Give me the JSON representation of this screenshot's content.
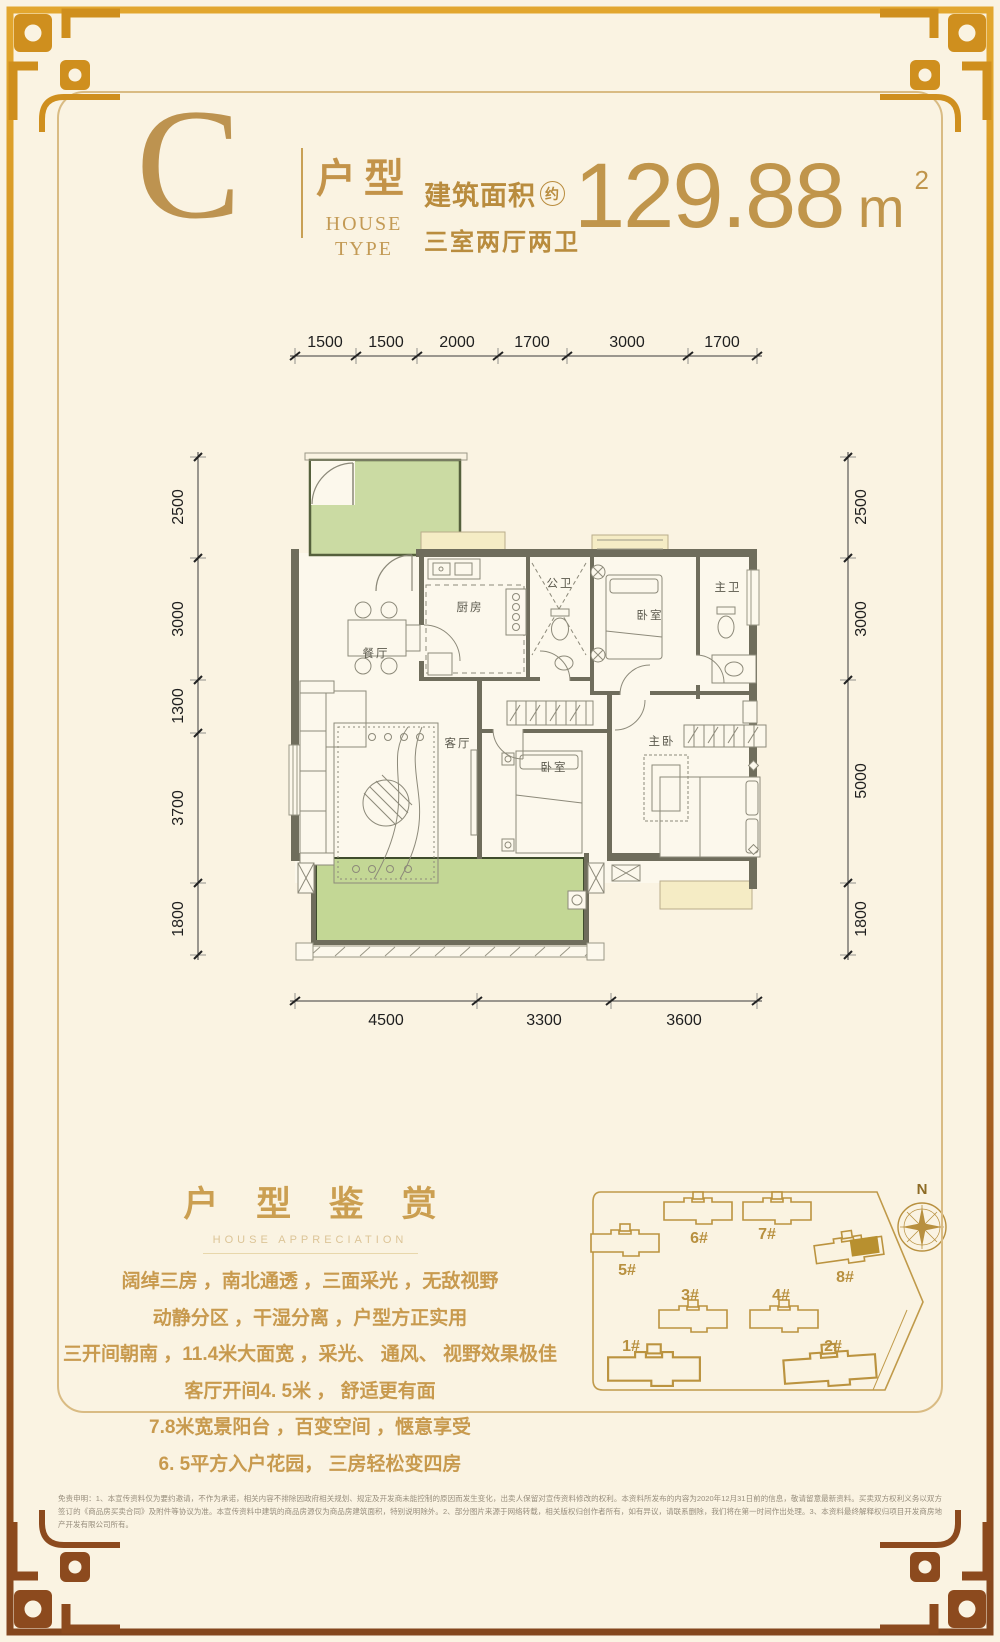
{
  "page": {
    "background": "#faf3e2",
    "frame_gold": "#cf8f1e",
    "frame_brown": "#8c4a1e",
    "accent_gold": "#c0954b"
  },
  "header": {
    "type_letter": "C",
    "type_label_cn": "户型",
    "type_label_en_line1": "HOUSE",
    "type_label_en_line2": "TYPE",
    "area_label": "建筑面积",
    "area_approx_badge": "约",
    "layout_label": "三室两厅两卫",
    "area_value": "129.88",
    "area_unit": "m",
    "area_unit_exponent": "2"
  },
  "floor_plan": {
    "dims_top": [
      "1500",
      "1500",
      "2000",
      "1700",
      "3000",
      "1700"
    ],
    "dims_left": [
      "2500",
      "3000",
      "1300",
      "3700",
      "1800"
    ],
    "dims_right": [
      "2500",
      "3000",
      "5000",
      "1800"
    ],
    "dims_bottom": [
      "4500",
      "3300",
      "3600"
    ],
    "rooms": {
      "kitchen": "厨房",
      "public_bath": "公卫",
      "bedroom_top": "卧室",
      "master_bath": "主卫",
      "dining": "餐厅",
      "living": "客厅",
      "bedroom_mid": "卧室",
      "master_bedroom": "主卧"
    }
  },
  "appreciation": {
    "title": "户 型 鉴 赏",
    "subtitle": "HOUSE APPRECIATION",
    "lines": [
      "阔绰三房 ，南北通透 ，三面采光 ，无敌视野",
      "动静分区 ，干湿分离 ，户型方正实用",
      "三开间朝南 ，11.4米大面宽 ，采光、 通风、 视野效果极佳",
      "客厅开间4. 5米 ， 舒适更有面",
      "7.8米宽景阳台 ，百变空间 ，惬意享受",
      "6. 5平方入户花园， 三房轻松变四房"
    ]
  },
  "site_plan": {
    "compass_label": "N",
    "buildings": {
      "b1": "1#",
      "b2": "2#",
      "b3": "3#",
      "b4": "4#",
      "b5": "5#",
      "b6": "6#",
      "b7": "7#",
      "b8": "8#"
    },
    "highlight_color": "#b8902f"
  },
  "disclaimer": {
    "text": "免责申明：1、本宣传资料仅为要约邀请，不作为承诺，相关内容不排除因政府相关规划、规定及开发商未能控制的原因而发生变化，出卖人保留对宣传资料修改的权利。本资料所发布的内容为2020年12月31日前的信息，敬请留意最新资料。买卖双方权利义务以双方签订的《商品房买卖合同》及附件等协议为准。本宣传资料中建筑的商品房源仅为商品房建筑面积，特别说明除外。2、部分图片来源于网络转载，相关版权归创作者所有，如有异议，请联系删除，我们将在第一时间作出处理。3、本资料最终解释权归项目开发商房地产开发有限公司所有。"
  }
}
